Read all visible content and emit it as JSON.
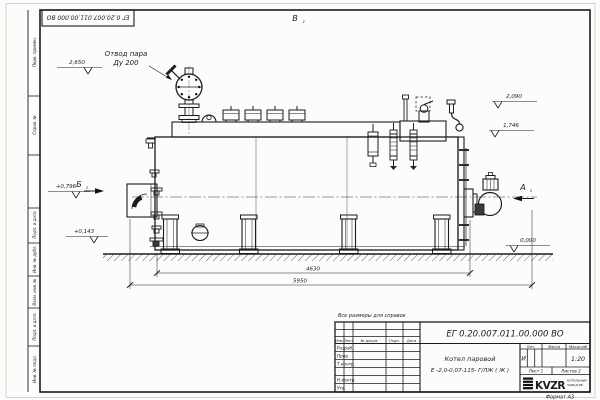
{
  "colors": {
    "line": "#1c1c1c",
    "paper": "#fcfcfa"
  },
  "stamp": {
    "doc_number_inverted": "ЕГ 0.20.007.011.00.000  ВО"
  },
  "note": "Все размеры для справок",
  "annotations": {
    "steam_outlet": {
      "line1": "Отвод пара",
      "line2": "Ду 200"
    },
    "views": {
      "a": "А",
      "b": "Б",
      "v": "В",
      "sheet_ref": "2"
    },
    "elevations": {
      "valve_top": "2,650",
      "safety_valve": "2,090",
      "deck": "1,746",
      "front_box": "+0,796",
      "lower_nozzle": "+0,143",
      "ground": "0,000"
    },
    "dimensions": {
      "support_span": "4630",
      "overall_length": "5950"
    }
  },
  "title_block": {
    "doc_number": "ЕГ 0.20.007.011.00.000  ВО",
    "name_line1": "Котел паровой",
    "name_line2": "Е -2,0-0,07-115- Г/ЛЖ ( Ж )",
    "headers": {
      "izm": "Изм.",
      "list": "Лист",
      "doc": "№ докум.",
      "podp": "Подп.",
      "date": "Дата",
      "lit": "Лит.",
      "mass": "Масса",
      "scale": "Масштаб"
    },
    "rows": [
      "Разраб.",
      "Пров.",
      "Т.контр.",
      "Н.контр.",
      "Утв."
    ],
    "lit_value": "И",
    "scale_value": "1:20",
    "sheet": "Лист 1",
    "sheets": "Листов 2",
    "logo": {
      "text": "KVZR",
      "caption1": "КОТЕЛЬНЫЙ",
      "caption2": "ЗАВОД РФ"
    },
    "format": "Формат А3"
  },
  "margins": {
    "labels": [
      "Перв. примен.",
      "Справ. №",
      "Подп. и дата",
      "Инв. № дубл.",
      "Взам. инв. №",
      "Подп. и дата",
      "Инв. № подл."
    ]
  }
}
